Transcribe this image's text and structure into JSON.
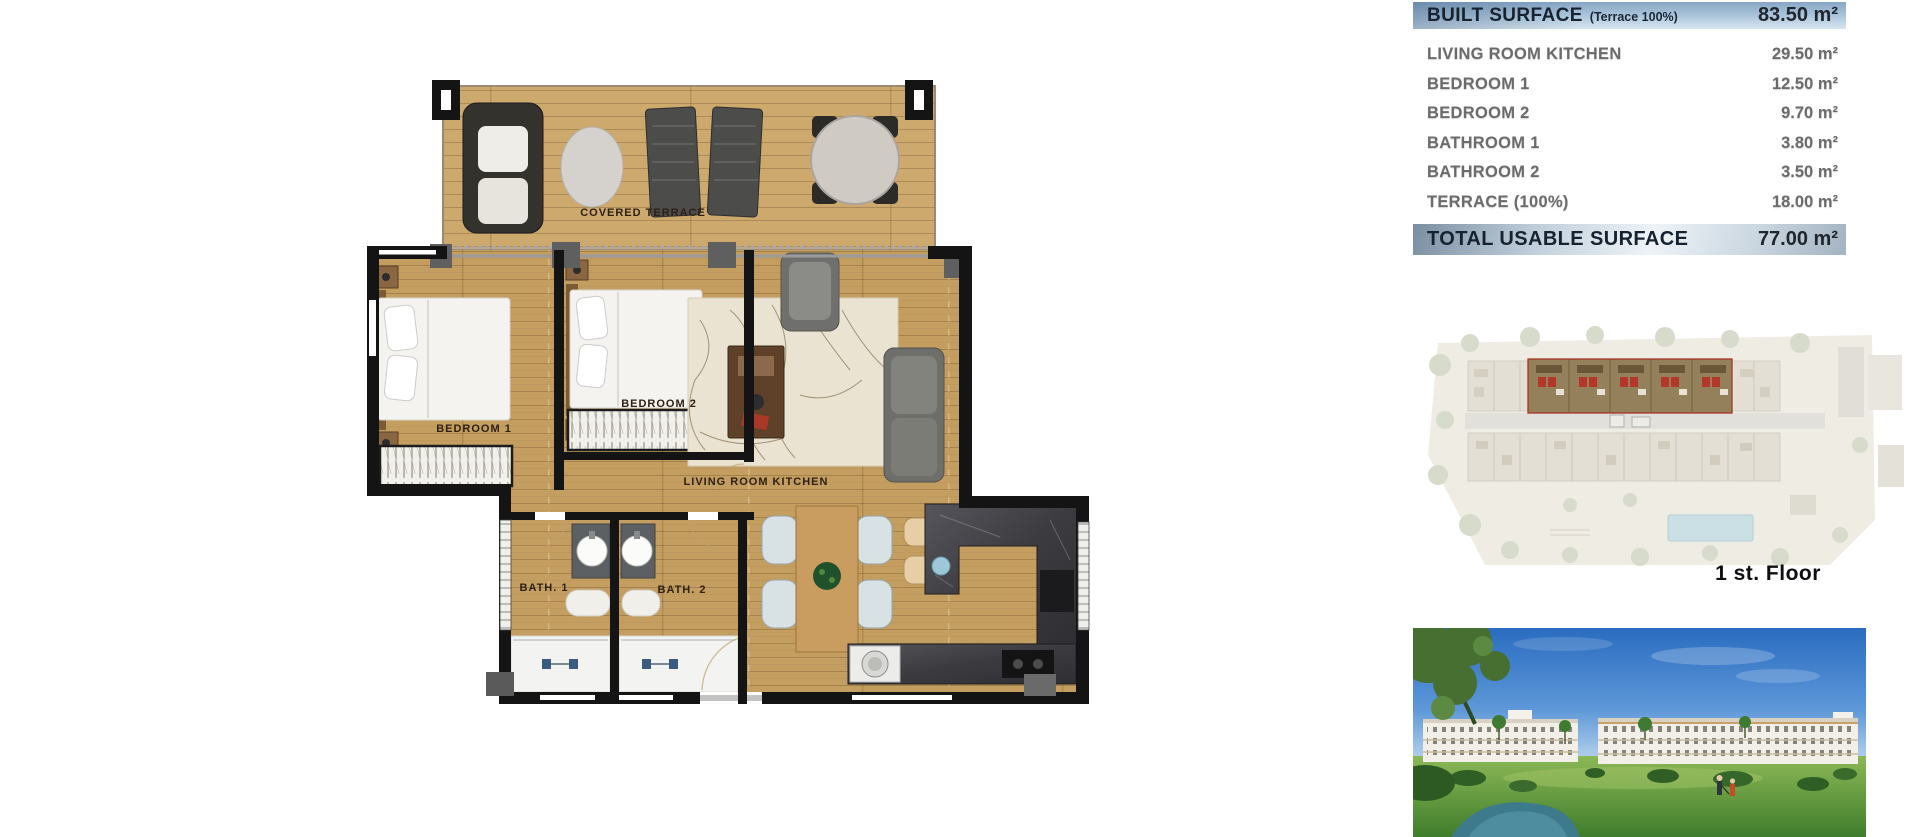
{
  "surface_table": {
    "header": {
      "label": "BUILT SURFACE",
      "note": "(Terrace 100%)",
      "value": "83.50 m²"
    },
    "rows": [
      {
        "label": "LIVING ROOM KITCHEN",
        "value": "29.50 m²"
      },
      {
        "label": "BEDROOM 1",
        "value": "12.50 m²"
      },
      {
        "label": "BEDROOM 2",
        "value": "9.70 m²"
      },
      {
        "label": "BATHROOM 1",
        "value": "3.80 m²"
      },
      {
        "label": "BATHROOM 2",
        "value": "3.50 m²"
      },
      {
        "label": "TERRACE (100%)",
        "value": "18.00 m²"
      }
    ],
    "total": {
      "label": "TOTAL USABLE SURFACE",
      "value": "77.00 m²"
    }
  },
  "floor_plan": {
    "labels": {
      "terrace": "COVERED TERRACE",
      "bedroom1": "BEDROOM 1",
      "bedroom2": "BEDROOM 2",
      "living": "LIVING ROOM KITCHEN",
      "bath1": "BATH. 1",
      "bath2": "BATH. 2"
    }
  },
  "site_plan": {
    "caption": "1 st. Floor"
  },
  "colors": {
    "table_header_blue": "#9bb8d3",
    "table_text_navy": "#16222f",
    "row_text_gray": "#6b6b6b",
    "wood_floor": "#c9a468",
    "wall_black": "#141414",
    "kitchen_marble": "#3f4044",
    "site_highlight_red": "#b03020",
    "photo_sky_blue": "#2f74c4",
    "photo_grass_green": "#4c8a33"
  }
}
